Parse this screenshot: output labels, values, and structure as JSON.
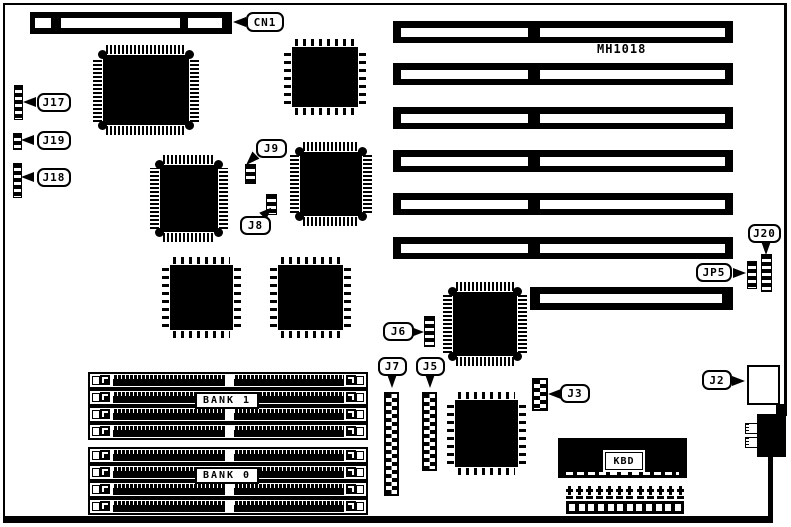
{
  "board": {
    "name": "MH1018"
  },
  "callouts": {
    "cn1": "CN1",
    "j17": "J17",
    "j19": "J19",
    "j18": "J18",
    "j9": "J9",
    "j8": "J8",
    "j6": "J6",
    "j7": "J7",
    "j5": "J5",
    "j3": "J3",
    "j2": "J2",
    "j20": "J20",
    "jp5": "JP5"
  },
  "memory": {
    "bank1_label": "BANK 1",
    "bank0_label": "BANK 0",
    "sockets_per_bank": 4
  },
  "kbd": {
    "label": "KBD"
  },
  "slots": {
    "full_count": 6,
    "short_count": 1
  },
  "power": {
    "pin_count": 12
  },
  "colors": {
    "ink": "#000000",
    "paper": "#ffffff"
  }
}
